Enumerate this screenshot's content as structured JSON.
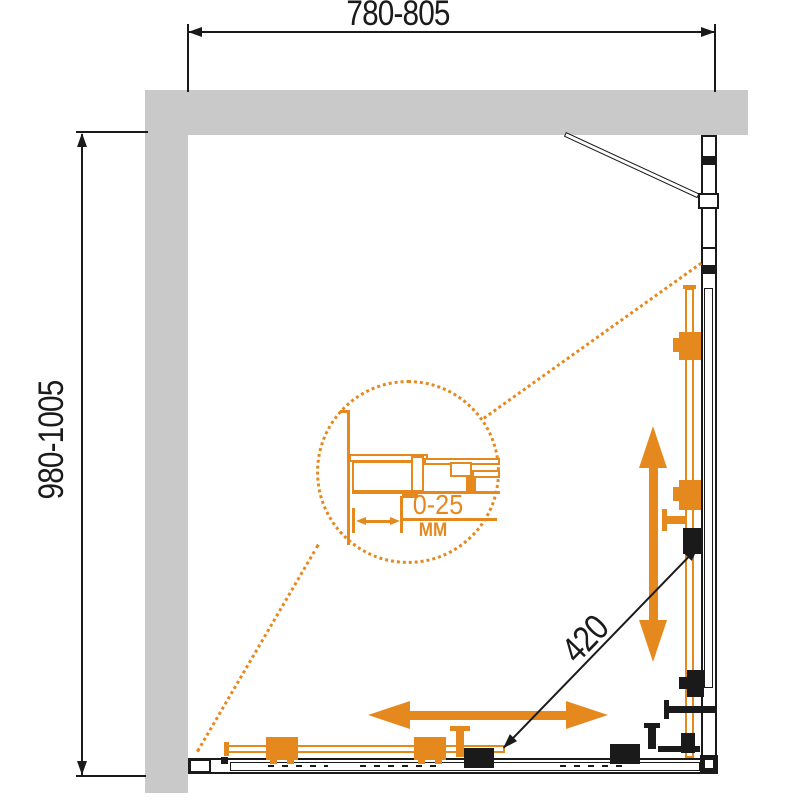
{
  "colors": {
    "accent": "#E5891E",
    "wall": "#C9C9C9",
    "line": "#1A1A1A"
  },
  "dimensions": {
    "width_label": "780-805",
    "depth_label": "980-1005",
    "diagonal_label": "420",
    "detail": {
      "range_label": "0-25",
      "unit_label": "MM"
    }
  }
}
